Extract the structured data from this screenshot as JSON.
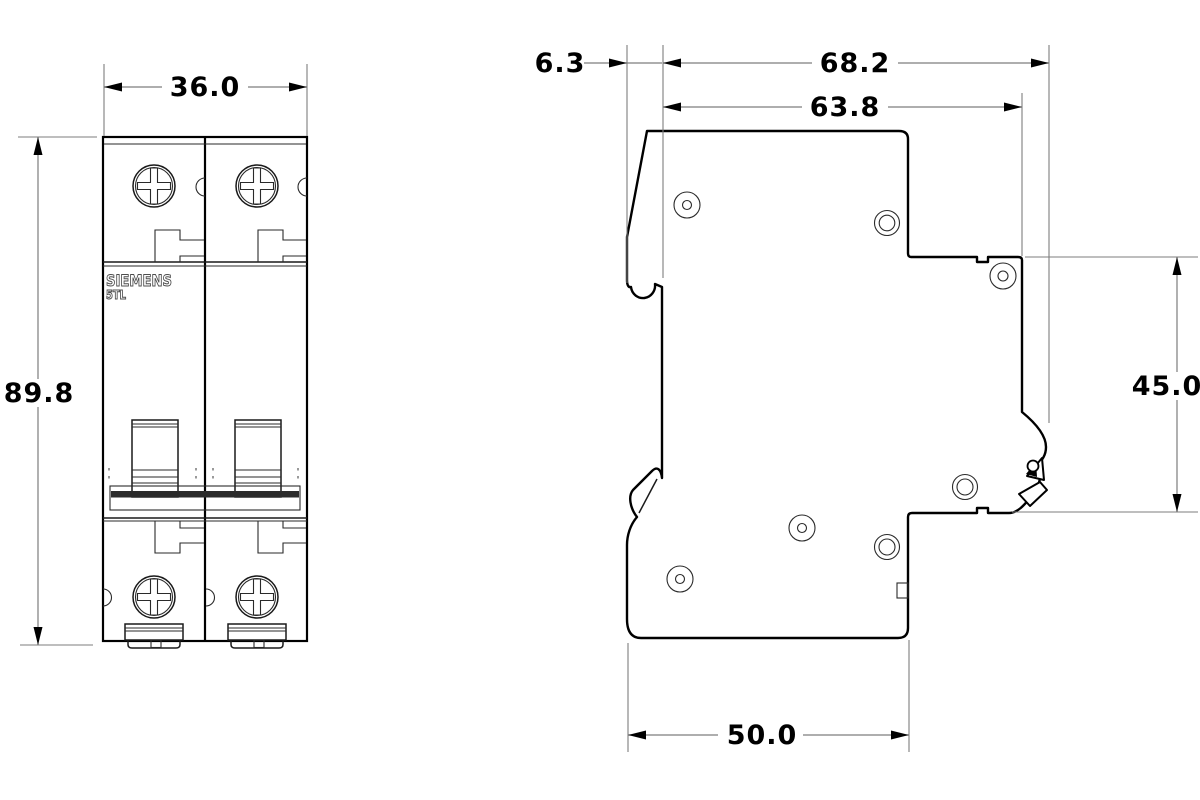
{
  "drawing": {
    "brand": "SIEMENS",
    "model": "5TL",
    "dims": {
      "front_width": "36.0",
      "front_height": "89.8",
      "side_left_offset": "6.3",
      "side_total_depth": "68.2",
      "side_body_depth": "63.8",
      "din_rail_height": "45.0",
      "base_depth": "50.0"
    },
    "colors": {
      "background": "#ffffff",
      "outline": "#000000",
      "dimension_lines": "#7d7d7d",
      "text": "#000000",
      "brand_stroke": "#4d4d4d"
    }
  }
}
